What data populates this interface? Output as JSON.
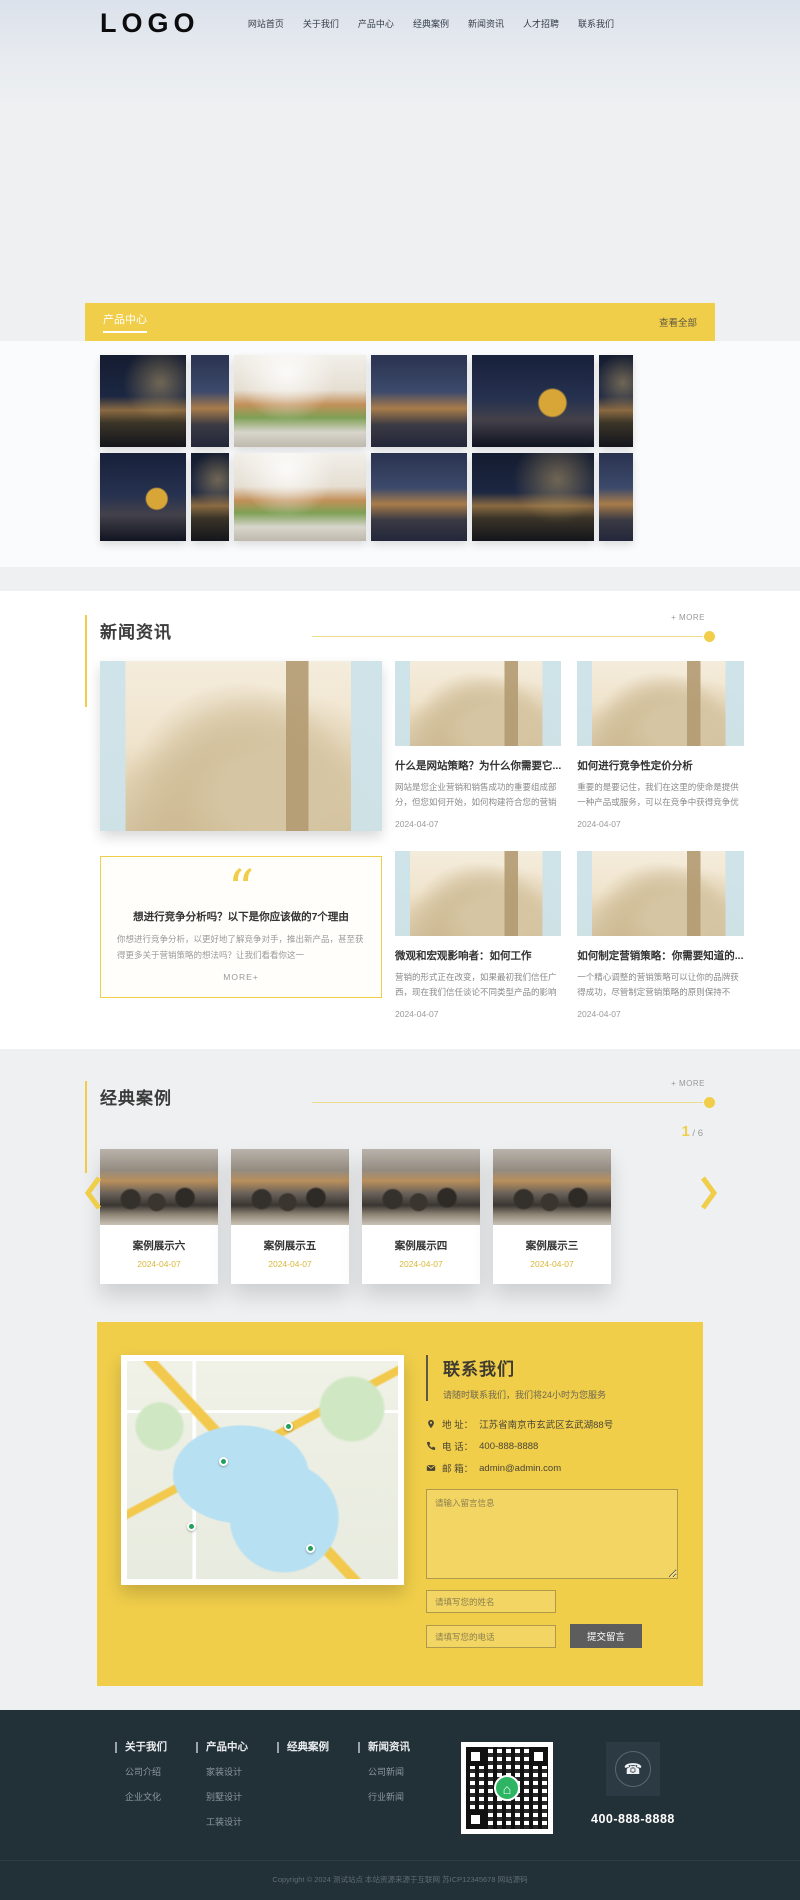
{
  "header": {
    "logo": "LOGO",
    "nav": [
      {
        "label": "网站首页"
      },
      {
        "label": "关于我们"
      },
      {
        "label": "产品中心"
      },
      {
        "label": "经典案例"
      },
      {
        "label": "新闻资讯"
      },
      {
        "label": "人才招聘"
      },
      {
        "label": "联系我们"
      }
    ]
  },
  "product_banner": {
    "title": "产品中心",
    "view_all": "查看全部"
  },
  "news": {
    "title": "新闻资讯",
    "more": "+ MORE",
    "quote": {
      "mark": "“",
      "title": "想进行竞争分析吗？以下是你应该做的7个理由",
      "desc": "你想进行竞争分析，以更好地了解竞争对手，推出新产品，甚至获得更多关于营销策略的想法吗？让我们看看你这一",
      "more": "MORE+"
    },
    "items": [
      {
        "title": "什么是网站策略？为什么你需要它...",
        "desc": "网站是您企业营销和销售成功的重要组成部分，但您如何开始，如何构建符合您的营销",
        "date": "2024-04-07"
      },
      {
        "title": "如何进行竞争性定价分析",
        "desc": "重要的是要记住，我们在这里的使命是提供一种产品或服务，可以在竞争中获得竞争优",
        "date": "2024-04-07"
      },
      {
        "title": "微观和宏观影响者：如何工作",
        "desc": "营销的形式正在改变，如果最初我们信任广西，现在我们信任谈论不同类型产品的影响",
        "date": "2024-04-07"
      },
      {
        "title": "如何制定营销策略：你需要知道的...",
        "desc": "一个精心调整的营销策略可以让你的品牌获得成功，尽管制定营销策略的原则保持不",
        "date": "2024-04-07"
      }
    ]
  },
  "cases": {
    "title": "经典案例",
    "more": "+ MORE",
    "page_current": "1",
    "page_rest": " / 6",
    "items": [
      {
        "title": "案例展示六",
        "date": "2024-04-07"
      },
      {
        "title": "案例展示五",
        "date": "2024-04-07"
      },
      {
        "title": "案例展示四",
        "date": "2024-04-07"
      },
      {
        "title": "案例展示三",
        "date": "2024-04-07"
      }
    ]
  },
  "contact": {
    "title": "联系我们",
    "subtitle": "请随时联系我们，我们将24小时为您服务",
    "address_label": "地 址：",
    "address": "江苏省南京市玄武区玄武湖88号",
    "phone_label": "电 话：",
    "phone": "400-888-8888",
    "email_label": "邮 箱：",
    "email": "admin@admin.com",
    "form": {
      "message_placeholder": "请输入留言信息",
      "name_placeholder": "请填写您的姓名",
      "phone_placeholder": "请填写您的电话",
      "submit": "提交留言"
    }
  },
  "footer": {
    "columns": [
      {
        "title": "关于我们",
        "links": [
          "公司介绍",
          "企业文化"
        ]
      },
      {
        "title": "产品中心",
        "links": [
          "家装设计",
          "别墅设计",
          "工装设计"
        ]
      },
      {
        "title": "经典案例",
        "links": []
      },
      {
        "title": "新闻资讯",
        "links": [
          "公司新闻",
          "行业新闻"
        ]
      }
    ],
    "phone_glyph": "☎",
    "hotline": "400-888-8888",
    "copyright": "Copyright © 2024 测试站点 本站资源来源于互联网 苏ICP12345678 网站源码"
  },
  "icons": {
    "qr_center": "⌂",
    "colors": {
      "accent": "#f0ce4a",
      "date_yellow": "#d8b83a",
      "footer_bg": "#223038",
      "submit_btn": "#5d5d5d"
    }
  }
}
